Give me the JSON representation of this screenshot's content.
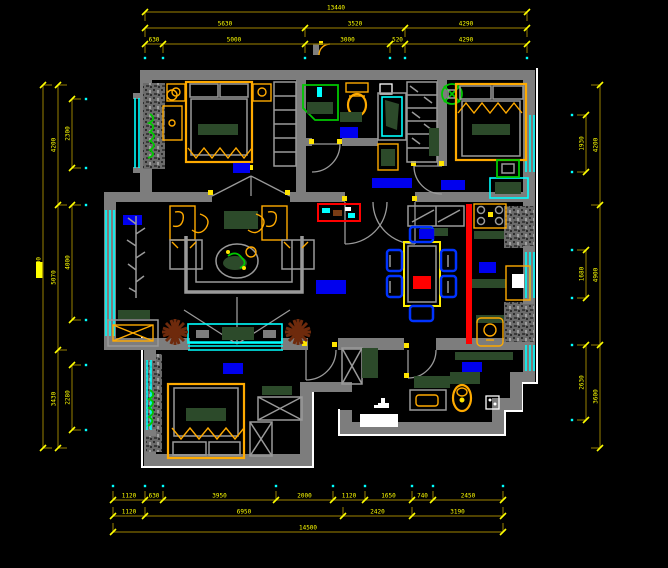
{
  "drawing": {
    "type": "apartment-floor-plan",
    "style": "CAD dark view"
  },
  "colors": {
    "background": "#000000",
    "wall": "#7d7d7d",
    "white_edge": "#ffffff",
    "dim_line": "#7f6a00",
    "dim_text": "#ffff00",
    "tick_cyan": "#00ffff",
    "window": "#00ffff",
    "furniture_orange": "#ffaa00",
    "table_yellow": "#ffee00",
    "soft_green": "#2c4a2a",
    "door_gray": "#9a9a9a",
    "label_blue": "#0000ee",
    "accent_red": "#ff0000",
    "plant_green": "#00c800",
    "plant_brown": "#6e2a0c",
    "chair_blue": "#0033ff",
    "nub_yellow": "#ffe400"
  },
  "dimensions": {
    "top": {
      "total": "13440",
      "row2": [
        "5630",
        "3520",
        "4290"
      ],
      "row3": [
        "630",
        "5000",
        "3000",
        "520",
        "4290"
      ]
    },
    "left": {
      "total": "12700",
      "mid": [
        "4200",
        "5070",
        "3430"
      ],
      "inner": [
        "2300",
        "4000",
        "2280"
      ]
    },
    "right": {
      "outer": [
        "4200",
        "4900",
        "3600"
      ],
      "inner": [
        "1930",
        "1680",
        "2630"
      ]
    },
    "bottom": {
      "row1": [
        "1120",
        "630",
        "3950",
        "2000",
        "1120",
        "1650",
        "740",
        "2450"
      ],
      "row2": [
        "1120",
        "6950",
        "2420",
        "3190"
      ],
      "total": "14500"
    }
  }
}
